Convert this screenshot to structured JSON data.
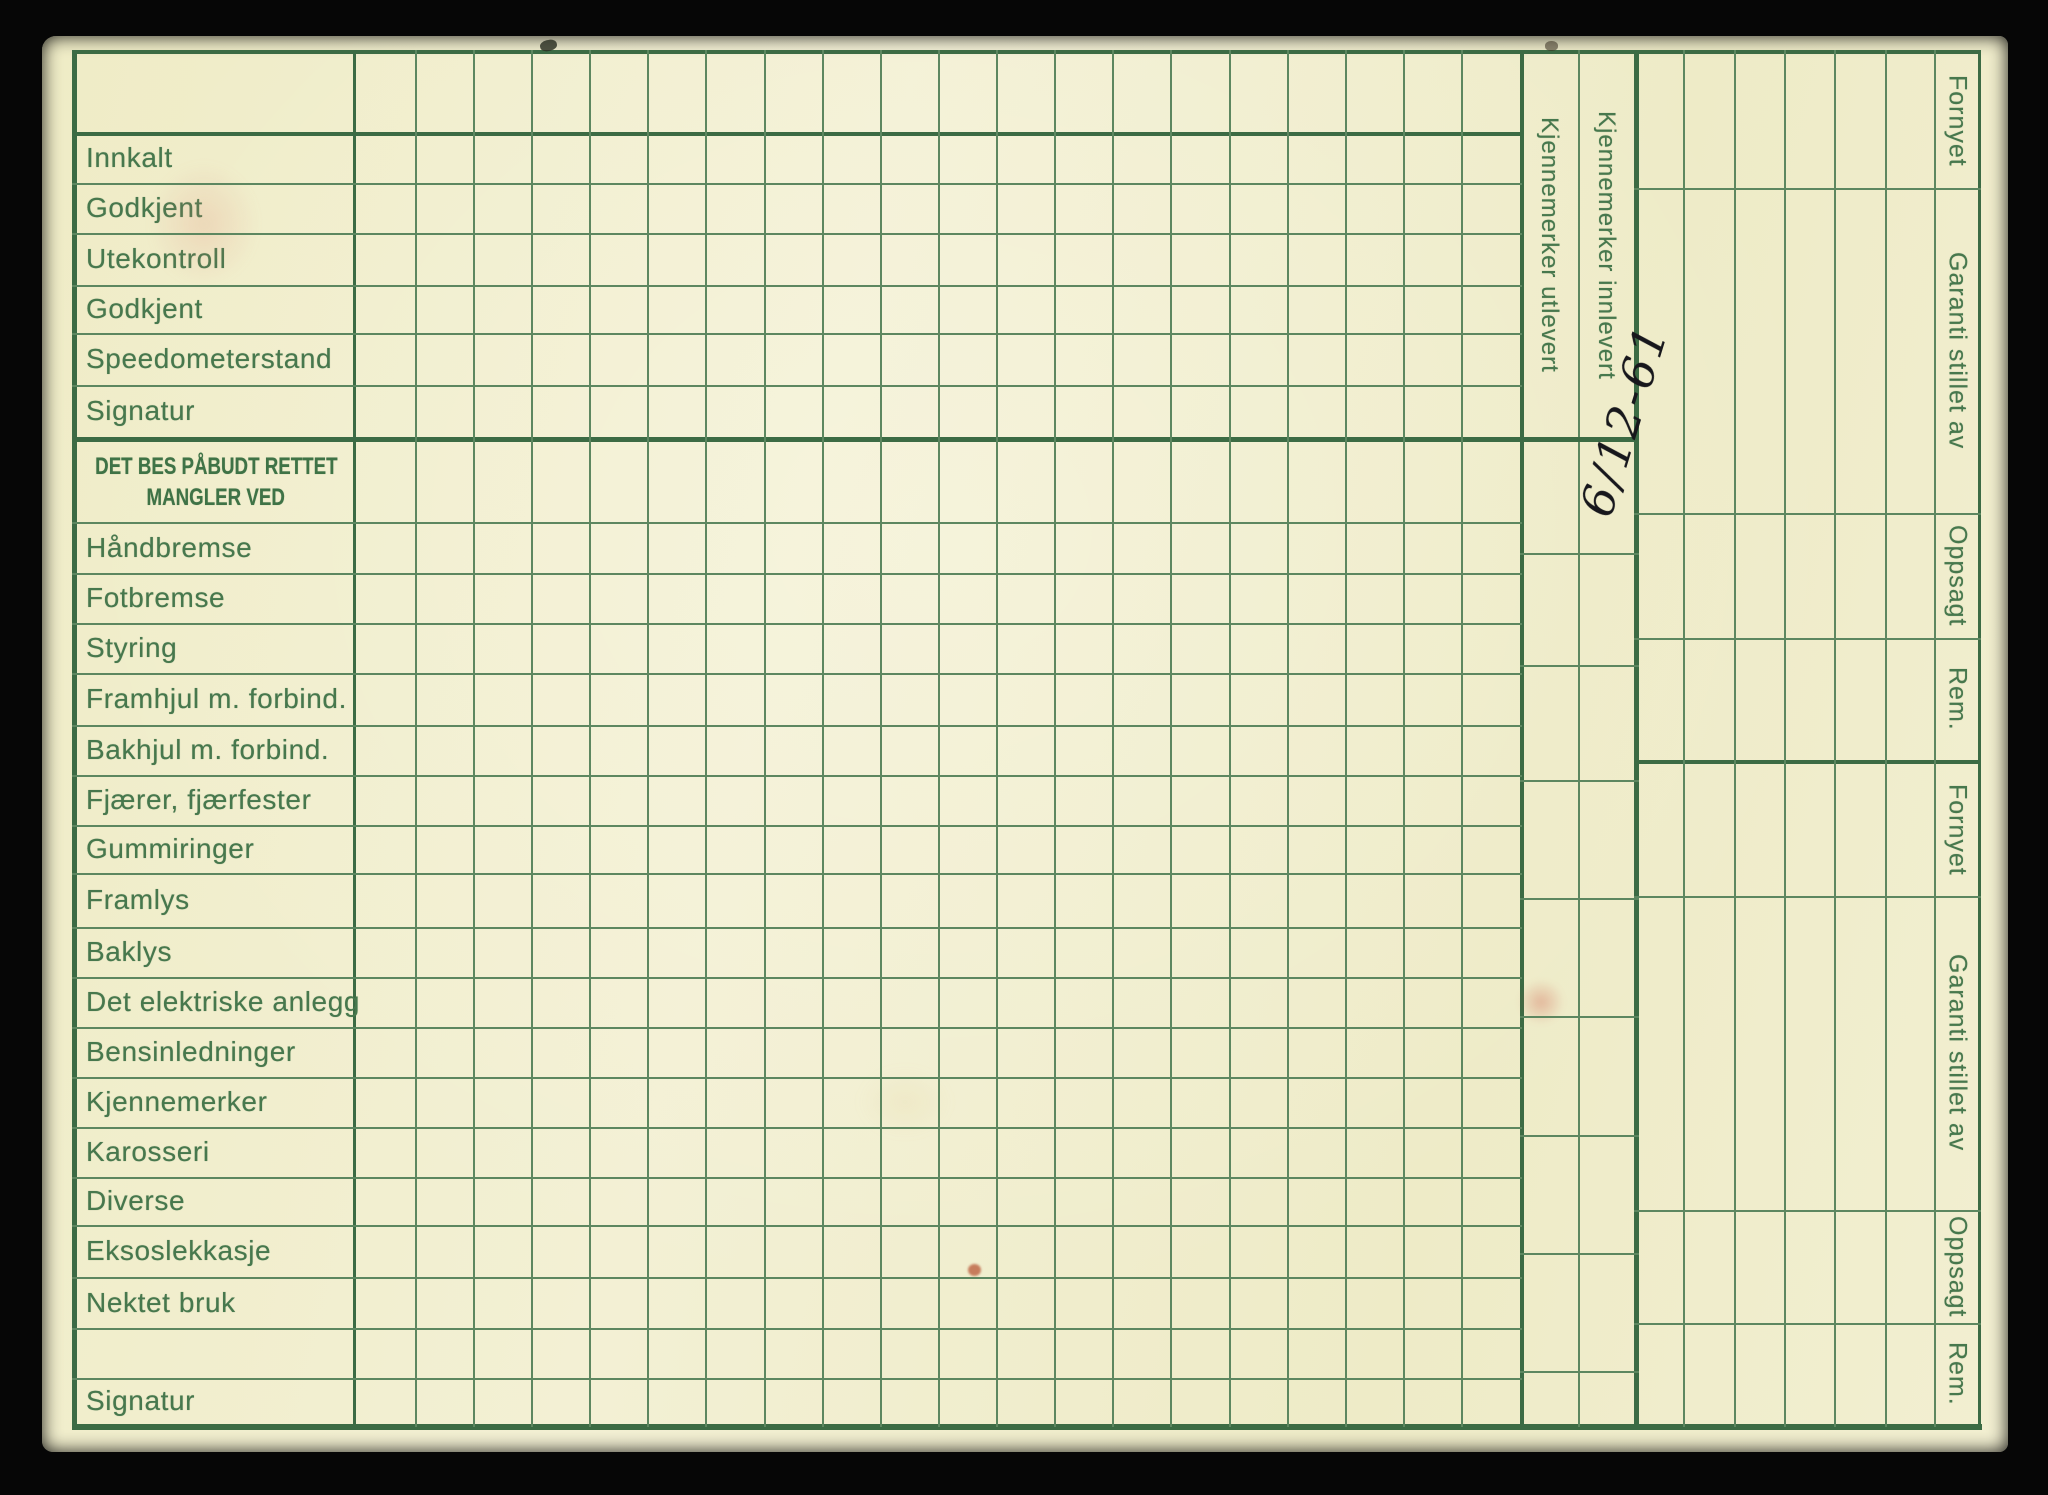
{
  "card": {
    "status_rows": [
      "Innkalt",
      "Godkjent",
      "Utekontroll",
      "Godkjent",
      "Speedometerstand",
      "Signatur"
    ],
    "defects_header": {
      "line1": "DET BES PÅBUDT RETTET",
      "line2": "MANGLER VED"
    },
    "defect_rows": [
      "Håndbremse",
      "Fotbremse",
      "Styring",
      "Framhjul m. forbind.",
      "Bakhjul m. forbind.",
      "Fjærer, fjærfester",
      "Gummiringer",
      "Framlys",
      "Baklys",
      "Det elektriske anlegg",
      "Bensinledninger",
      "Kjennemerker",
      "Karosseri",
      "Diverse",
      "Eksoslekkasje",
      "Nektet bruk"
    ],
    "bottom_row": "Signatur",
    "plate_columns": {
      "issued": "Kjennemerker utlevert",
      "returned": "Kjennemerker innlevert"
    },
    "right_margin": {
      "upper": [
        "Fornyet",
        "Garanti stillet av",
        "Oppsagt",
        "Rem."
      ],
      "lower": [
        "Fornyet",
        "Garanti stillet av",
        "Oppsagt",
        "Rem."
      ]
    },
    "handwritten": {
      "date": "6/12-61"
    },
    "colors": {
      "paper": "#f1eecd",
      "grid_line": "#4c7a50",
      "label_text": "#47784d",
      "ink": "#17171c",
      "background": "#060606"
    }
  }
}
